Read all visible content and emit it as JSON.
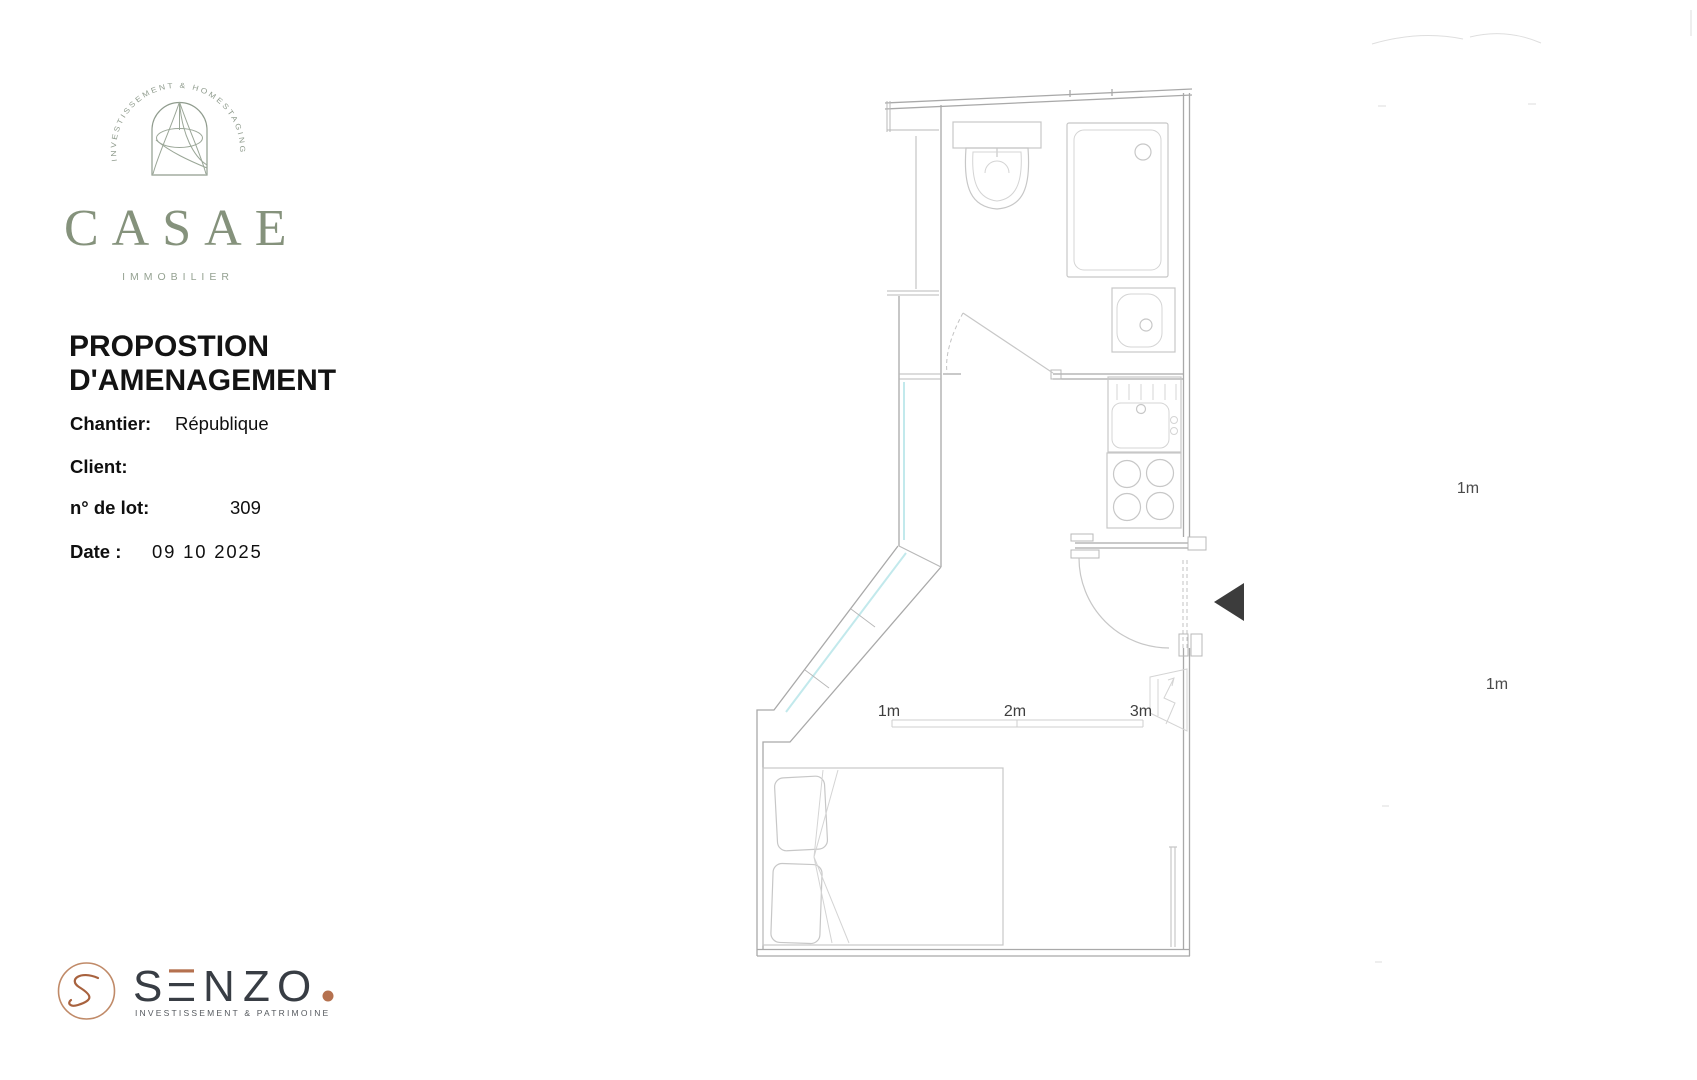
{
  "branding": {
    "casae": {
      "arc_text": "INVESTISSEMENT & HOMESTAGING",
      "wordmark": "CASAE",
      "subtitle": "IMMOBILIER",
      "brand_color": "#85927c"
    },
    "senzo": {
      "letters": {
        "s": "S",
        "n": "N",
        "z": "Z",
        "o": "O"
      },
      "tagline": "INVESTISSEMENT & PATRIMOINE",
      "copper": "#b5714f",
      "dark": "#383d44"
    }
  },
  "document": {
    "title": [
      "PROPOSTION",
      "D'AMENAGEMENT"
    ],
    "fields": [
      {
        "label": "Chantier:",
        "value": "République"
      },
      {
        "label": "Client:",
        "value": ""
      },
      {
        "label": "n° de lot:",
        "value": "309"
      },
      {
        "label": "Date :",
        "value": "09 10 2025"
      }
    ]
  },
  "floor_plan": {
    "scale_ticks": [
      "1m",
      "2m",
      "3m"
    ],
    "side_labels": [
      "1m",
      "1m"
    ],
    "colors": {
      "line": "#c6c6c6",
      "wall": "#a9a9a9",
      "closet_accent": "#c2e9ec",
      "entrance_arrow": "#3c3c3c",
      "label_text": "#3f3f3f"
    },
    "fixtures": [
      "toilet",
      "shower",
      "washbasin",
      "bathroom-door",
      "kitchen-sink",
      "stove",
      "entry-door",
      "closet",
      "double-bed",
      "window",
      "radiator",
      "entrance-arrow"
    ]
  }
}
